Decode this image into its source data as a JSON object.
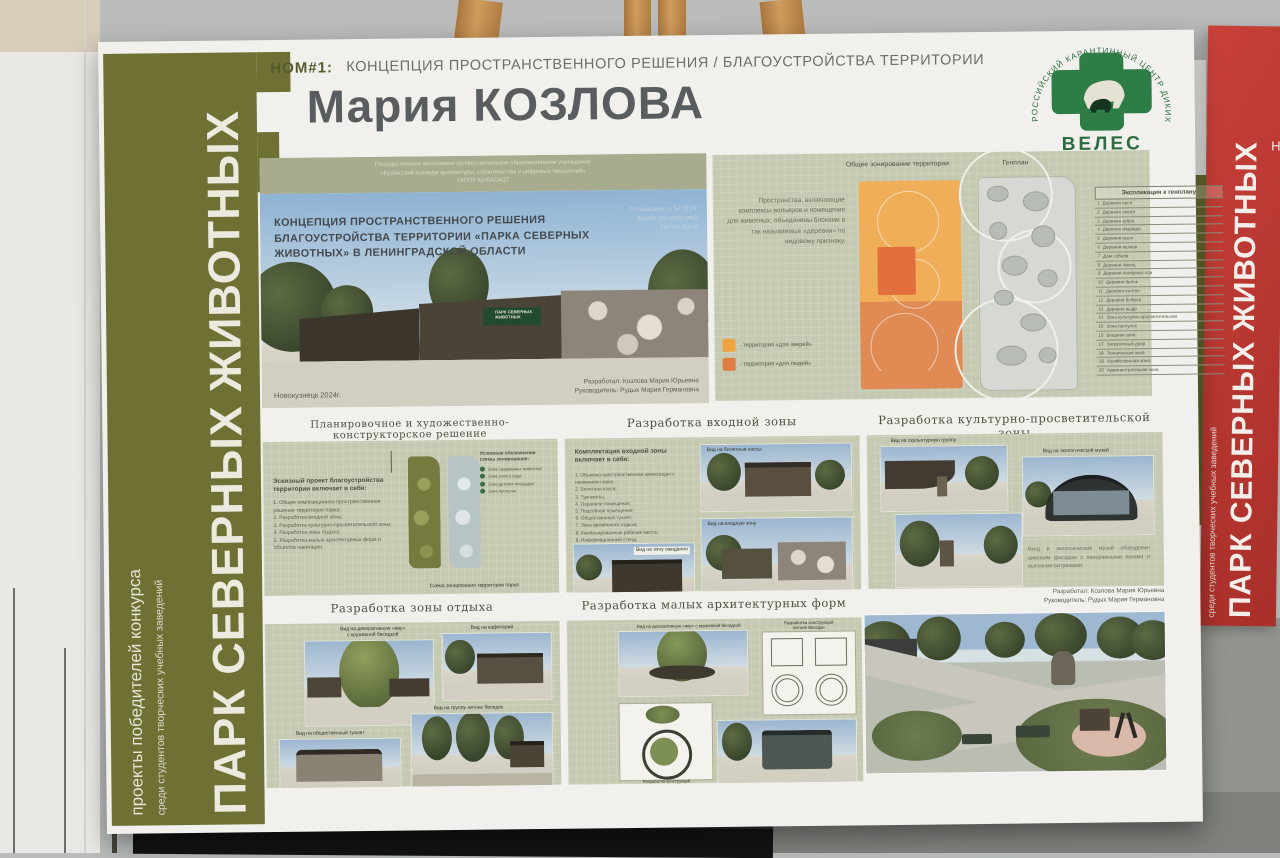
{
  "background": {
    "right_poster": {
      "big_vertical": "ПАРК СЕВЕРНЫХ ЖИВОТНЫХ",
      "small_vertical": "среди студентов творческих учебных заведений",
      "corner_fragment": "Н"
    }
  },
  "sidebar": {
    "big": "ПАРК СЕВЕРНЫХ ЖИВОТНЫХ",
    "medium": "проекты победителей конкурса",
    "small": "среди студентов творческих учебных заведений"
  },
  "header": {
    "nom": "НОМ#1:",
    "category": "КОНЦЕПЦИЯ ПРОСТРАНСТВЕННОГО РЕШЕНИЯ / БЛАГОУСТРОЙСТВА ТЕРРИТОРИИ",
    "author": "Мария КОЗЛОВА"
  },
  "logo": {
    "arc": "РОССИЙСКИЙ КАРАНТИННЫЙ ЦЕНТР ДИКИХ ЖИВОТНЫХ",
    "name": "ВЕЛЕС"
  },
  "hero": {
    "college": "Государственное автономное профессиональное образовательное учреждение\n«Кузбасский колледж архитектуры, строительства и цифровых технологий»\nГАПОУ КузКАСиЦТ",
    "title": "КОНЦЕПЦИЯ ПРОСТРАНСТВЕННОГО РЕШЕНИЯ\nБЛАГОУСТРОЙСТВА ТЕРРИТОРИИ «ПАРКА СЕВЕРНЫХ\nЖИВОТНЫХ» В ЛЕНИНГРАДСКОЙ ОБЛАСТИ",
    "specialty": "Специальность 54.02.01\nДизайн (по отраслям)\nГруппа Диз-3",
    "sign": "ПАРК СЕВЕРНЫХ\nЖИВОТНЫХ",
    "city_year": "Новокузнецк 2024г.",
    "developed": "Разработал: Козлова Мария Юрьевна",
    "supervisor": "Руководитель: Рудых Мария Германовна"
  },
  "zoning": {
    "heading_left": "Общее зонирование территории",
    "heading_right": "Генплан",
    "description": "Пространства, включающие комплексы вольеров и помещения для животных, объединены блоками в так называемые «деревни» по видовому признаку.",
    "legend": [
      {
        "label": "- территория «для зверей»",
        "color": "#efa43f"
      },
      {
        "label": "- территория «для людей»",
        "color": "#de7e42"
      }
    ],
    "table_title": "Экспликация к генплану",
    "rows": [
      {
        "n": "1",
        "label": "Деревня лося"
      },
      {
        "n": "2",
        "label": "Деревня оленя"
      },
      {
        "n": "3",
        "label": "Деревня зубра"
      },
      {
        "n": "4",
        "label": "Деревня медведя"
      },
      {
        "n": "5",
        "label": "Деревня рыси"
      },
      {
        "n": "6",
        "label": "Деревня волков"
      },
      {
        "n": "7",
        "label": "Дом соболя"
      },
      {
        "n": "8",
        "label": "Деревня лисиц"
      },
      {
        "n": "9",
        "label": "Деревня полярных сов"
      },
      {
        "n": "10",
        "label": "Деревня белок"
      },
      {
        "n": "11",
        "label": "Деревня енотов"
      },
      {
        "n": "12",
        "label": "Деревня бобров"
      },
      {
        "n": "13",
        "label": "Деревня выдр"
      },
      {
        "n": "14",
        "label": "Зона культурно-просветительная"
      },
      {
        "n": "15",
        "label": "Зона прогулок"
      },
      {
        "n": "16",
        "label": "Входная зона"
      },
      {
        "n": "17",
        "label": "Загрузочный двор"
      },
      {
        "n": "18",
        "label": "Техническая зона"
      },
      {
        "n": "19",
        "label": "Хозяйственная зона"
      },
      {
        "n": "20",
        "label": "Административная зона"
      }
    ]
  },
  "planning": {
    "title": "Планировочное и художественно-конструкторское решение",
    "lead": "Эскизный проект благоустройства территории включает в себя:",
    "items": [
      "1. Общее композиционно-пространственное решение территории парка;",
      "2. Разработка входной зоны;",
      "3. Разработка культурно-просветительской зоны;",
      "4. Разработка зоны отдыха;",
      "5. Разработка малых архитектурных форм и объектов навигации."
    ],
    "legend_title": "Условные обозначения\nсхемы зонирования:",
    "legend_items": [
      "Зона «деревень» животных",
      "Зона тихого сада",
      "Зона детских площадок",
      "Зона прогулок"
    ],
    "caption": "Схема зонирования территории парка"
  },
  "entrance": {
    "title": "Разработка входной зоны",
    "lead": "Комплектация входной зоны\nвключает в себя:",
    "items": [
      "1. Объемно-пространственная композиция с названием парка;",
      "2. Билетная касса;",
      "3. Турникеты;",
      "4. Охранное помещение;",
      "5. Подсобное помещение;",
      "6. Общественный туалет;",
      "7. Зона временного отдыха;",
      "8. Комбинированные рабочие места;",
      "9. Информационный стенд."
    ],
    "cap_ticket": "Вид на билетные кассы",
    "cap_wait": "Вид на зону ожидания",
    "cap_entry": "Вид на входную зону"
  },
  "culture": {
    "title": "Разработка культурно-просветительской зоны",
    "cap_sculpture": "Вид на скульптурную группу",
    "cap_museum": "Вид на экологический музей",
    "paragraph": "Вход в экологический музей оборудован широким фасадом с панорамными окнами и высокими витражами."
  },
  "leisure": {
    "title": "Разработка зоны отдыха",
    "cap_willow": "Вид на декоративную «иву»\nс кружевной беседкой",
    "cap_cafe": "Вид на кафетерий",
    "cap_wc": "Вид на общественный туалет",
    "cap_gazebos": "Вид на группу летних беседок"
  },
  "maf": {
    "title": "Разработка малых архитектурных форм",
    "cap_willow_view": "Вид на декоративную «иву» с кружевной беседкой",
    "cap_gazebo_constr": "Разработка конструкций\nлетней беседки",
    "cap_willow_constr": "Разработка конструкций\n«ивы» с кружевной беседкой",
    "cap_gazebo_view": "Вид на летнюю беседку"
  },
  "credits": {
    "developed": "Разработал: Козлова Мария Юрьевна",
    "supervisor": "Руководитель: Рудых Мария Германовна"
  }
}
